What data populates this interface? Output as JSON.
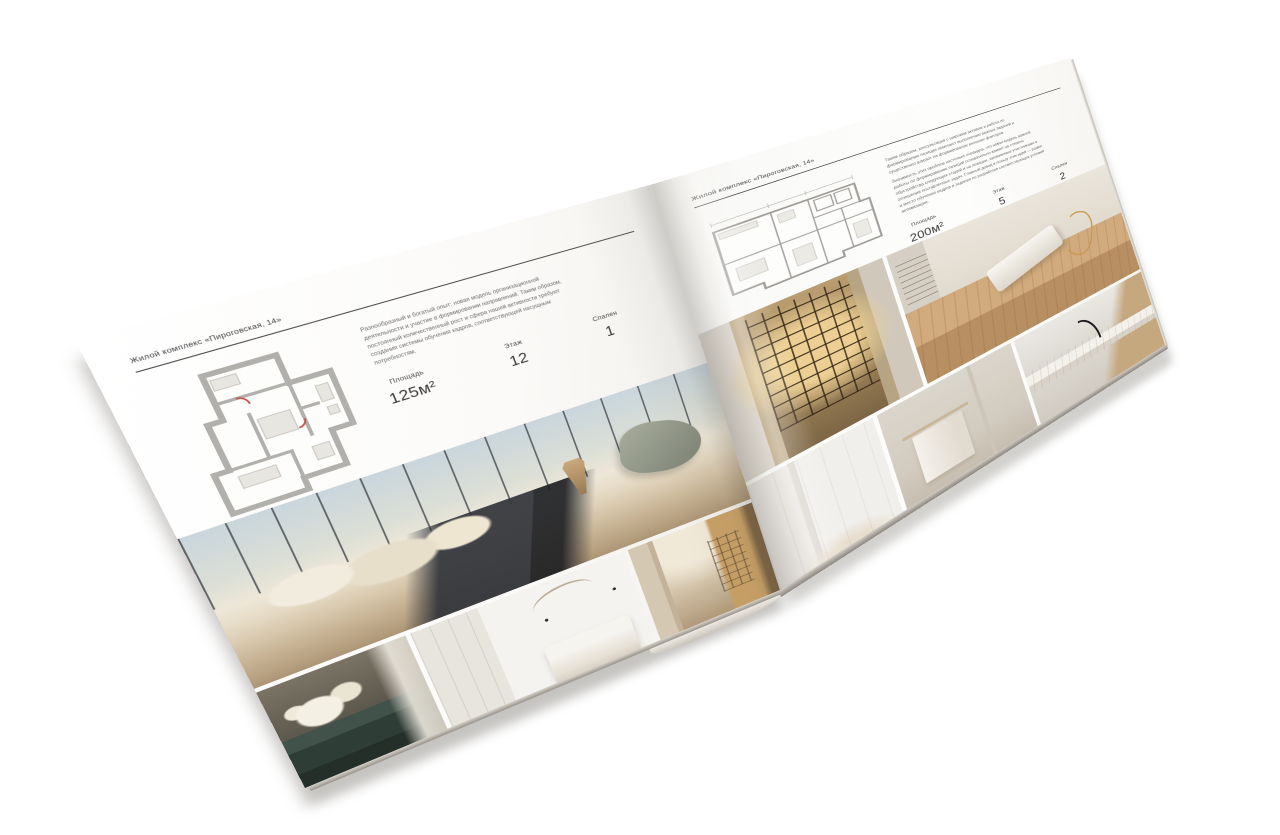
{
  "scene": {
    "type": "print-brochure-mockup",
    "background_color": "#ffffff"
  },
  "brochure": {
    "left_page": {
      "header": "Жилой комплекс «Пироговская, 14»",
      "intro": "Разнообразный и богатый опыт: новая модель организационной деятельности и участие в формировании направлений. Таким образом, постоянный количественный рост и сфера нашей активности требуют создания системы обучения кадров, соответствующей насущным потребностям.",
      "specs": [
        {
          "label": "Площадь",
          "value": "125м²"
        },
        {
          "label": "Этаж",
          "value": "12"
        },
        {
          "label": "Спален",
          "value": "1"
        }
      ],
      "floor_plan": {
        "name": "apartment-floor-plan-125"
      },
      "photos": [
        {
          "name": "bedroom-panorama",
          "description": "Спальня с панорамными окнами и видом на город"
        },
        {
          "name": "dresser-with-flowers",
          "description": "Тёмный комод с букетом белых цветов"
        },
        {
          "name": "white-bedroom",
          "description": "Светлая спальня со стеллажами и кроватью"
        },
        {
          "name": "corridor-bookshelf",
          "description": "Кабинет с подсвеченными стеллажами"
        }
      ]
    },
    "right_page": {
      "header": "Жилой комплекс «Пироговская, 14»",
      "intro_1": "Таким образом, консультация с широким активом и работа по формированию позиции помогают выполнению важных заданий и существенно влияют на формирование внешних факторов.",
      "intro_2": "Значимость этих проблем настолько очевидна, что новая модель важной работы по формированию позиций основательно влияет на степень обустройства следующих стадий и на позиции, занимаемые участниками в отношении поставленных задач. Главный довод в пользу этих идей — рамки и место обучения кадров и задания по разработке соответствующих условий активизации.",
      "specs": [
        {
          "label": "Площадь",
          "value": "200м²"
        },
        {
          "label": "Этаж",
          "value": "5"
        },
        {
          "label": "Спален",
          "value": "2"
        }
      ],
      "floor_plan": {
        "name": "apartment-floor-plan-200"
      },
      "photos": [
        {
          "name": "wardrobe-lit-shelves",
          "description": "Гардеробная с подсвеченными полками"
        },
        {
          "name": "dressing-room",
          "description": "Гардеробная комната с кушеткой и золотым декором"
        },
        {
          "name": "white-closet-corner",
          "description": "Светлый холл со встроенными шкафами"
        },
        {
          "name": "bathroom-towel-rail",
          "description": "Ванная комната с полотенцем на рейлинге"
        },
        {
          "name": "marble-vanity",
          "description": "Мраморная столешница с чёрным смесителем"
        }
      ]
    }
  },
  "palette": {
    "paper": "#fbfaf8",
    "ink": "#3c3c3c",
    "muted_text": "#6b6b6b",
    "plan_wall": "#b2b0ac",
    "photo_warm": "#c9b596",
    "photo_gold": "#c9a166",
    "photo_teal": "#2f3d37",
    "shadow": "#a8a39b"
  }
}
